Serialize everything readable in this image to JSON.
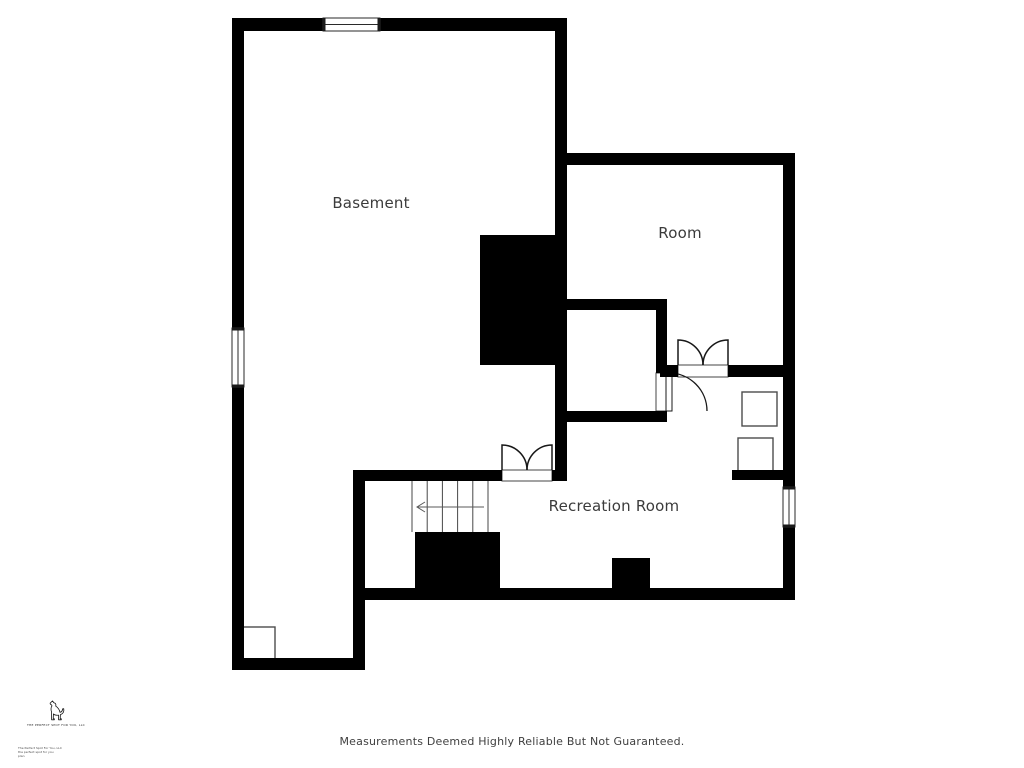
{
  "page": {
    "background": "#ffffff",
    "disclaimer": "Measurements Deemed Highly Reliable But Not Guaranteed."
  },
  "labels": {
    "basement": {
      "text": "Basement",
      "x": 371,
      "y": 203
    },
    "room": {
      "text": "Room",
      "x": 680,
      "y": 233
    },
    "recreation": {
      "text": "Recreation Room",
      "x": 614,
      "y": 506
    }
  },
  "logo": {
    "caption": "THE PERFECT SPOT FOR YOU, LLC",
    "fine_print_lines": [
      "The Perfect Spot For You, LLC",
      "the perfect spot for you",
      "plan"
    ]
  },
  "colors": {
    "wall": "#000000",
    "door_line": "#181818",
    "frame_line": "#444444",
    "fixture_line": "#4c4c4c",
    "stair_line": "#474747",
    "arrow_line": "#5a5a5a",
    "window_line": "#2a2a2a",
    "label_text": "#3b3b3b"
  },
  "plan": {
    "walls": [
      {
        "x": 232,
        "y": 18,
        "w": 91,
        "h": 13
      },
      {
        "x": 380,
        "y": 18,
        "w": 187,
        "h": 13
      },
      {
        "x": 232,
        "y": 18,
        "w": 12,
        "h": 310
      },
      {
        "x": 232,
        "y": 387,
        "w": 12,
        "h": 283
      },
      {
        "x": 232,
        "y": 658,
        "w": 133,
        "h": 12
      },
      {
        "x": 353,
        "y": 470,
        "w": 12,
        "h": 200
      },
      {
        "x": 353,
        "y": 470,
        "w": 149,
        "h": 11
      },
      {
        "x": 552,
        "y": 470,
        "w": 15,
        "h": 11
      },
      {
        "x": 555,
        "y": 18,
        "w": 12,
        "h": 463
      },
      {
        "x": 555,
        "y": 153,
        "w": 240,
        "h": 12
      },
      {
        "x": 783,
        "y": 153,
        "w": 12,
        "h": 334
      },
      {
        "x": 783,
        "y": 527,
        "w": 12,
        "h": 70
      },
      {
        "x": 660,
        "y": 365,
        "w": 18,
        "h": 12
      },
      {
        "x": 728,
        "y": 365,
        "w": 67,
        "h": 12
      },
      {
        "x": 557,
        "y": 299,
        "w": 110,
        "h": 11
      },
      {
        "x": 656,
        "y": 299,
        "w": 11,
        "h": 74
      },
      {
        "x": 656,
        "y": 411,
        "w": 11,
        "h": 11
      },
      {
        "x": 557,
        "y": 411,
        "w": 110,
        "h": 11
      },
      {
        "x": 732,
        "y": 470,
        "w": 63,
        "h": 10
      },
      {
        "x": 353,
        "y": 588,
        "w": 442,
        "h": 12
      }
    ],
    "blocks": [
      {
        "x": 480,
        "y": 235,
        "w": 77,
        "h": 130
      },
      {
        "x": 415,
        "y": 532,
        "w": 85,
        "h": 60
      },
      {
        "x": 612,
        "y": 558,
        "w": 38,
        "h": 34
      }
    ],
    "windows": [
      {
        "x": 323,
        "y": 18,
        "w": 57,
        "h": 13,
        "orient": "h"
      },
      {
        "x": 232,
        "y": 328,
        "w": 12,
        "h": 59,
        "orient": "v"
      },
      {
        "x": 783,
        "y": 487,
        "w": 12,
        "h": 40,
        "orient": "v"
      }
    ],
    "double_doors": [
      {
        "x": 502,
        "y": 470,
        "w": 50,
        "wall": 11
      },
      {
        "x": 678,
        "y": 365,
        "w": 50,
        "wall": 12
      }
    ],
    "single_door": {
      "frame": {
        "x": 656,
        "y": 373,
        "w": 11,
        "h": 38
      },
      "leaf": {
        "x": 666,
        "y": 373,
        "w": 6,
        "h": 38
      },
      "arc": "M 669 373 A 38 38 0 0 1 707 411"
    },
    "stairs": {
      "x": 412,
      "y": 481,
      "w": 76,
      "h": 51,
      "treads": 6,
      "arrow": {
        "xTail": 484,
        "xHead": 417,
        "y": 507
      }
    },
    "fixtures": [
      {
        "x": 742,
        "y": 392,
        "w": 35,
        "h": 34
      },
      {
        "x": 738,
        "y": 438,
        "w": 35,
        "h": 34
      },
      {
        "x": 240,
        "y": 627,
        "w": 35,
        "h": 33
      }
    ]
  }
}
